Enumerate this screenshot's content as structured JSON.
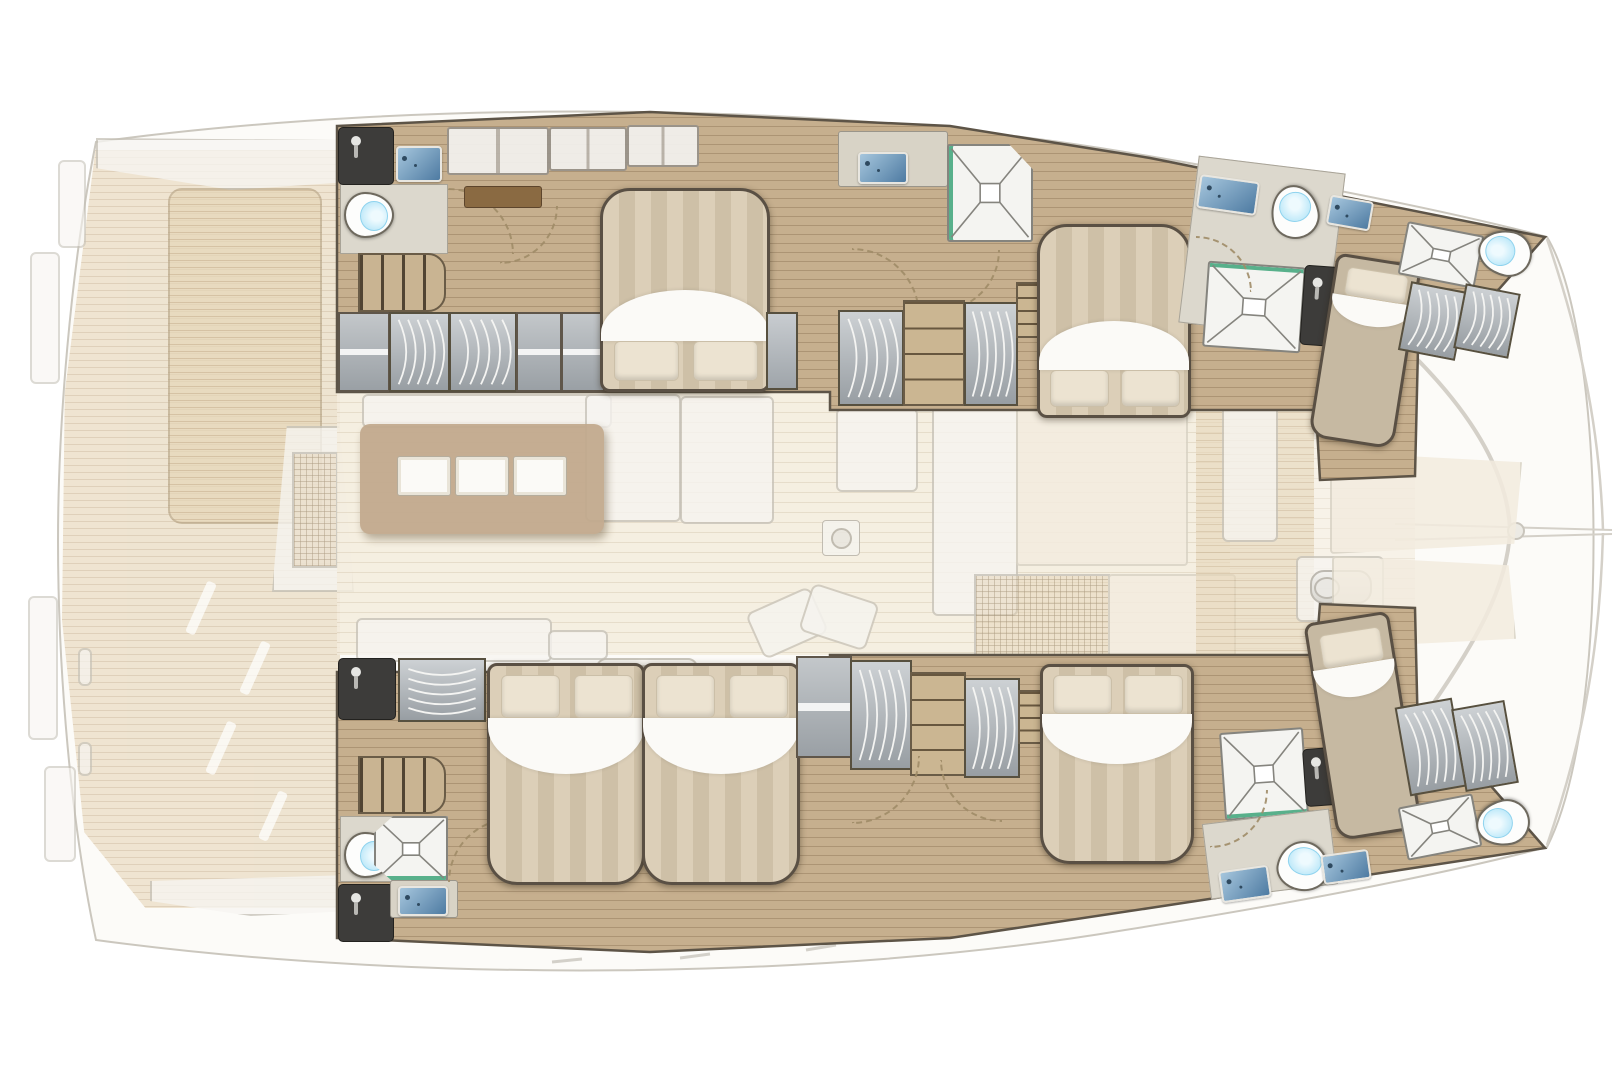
{
  "document": {
    "kind": "illustration",
    "subject": "catamaran yacht interior deck plan, top-down view",
    "visible_text": [],
    "orientation": {
      "bow": "right",
      "stern": "left",
      "port_hull": "top",
      "starboard_hull": "bottom"
    }
  },
  "areas": {
    "aft_deck": {
      "name": "aft cockpit deck",
      "style": "ghosted (semi-transparent)",
      "features": [
        "teak planked deck",
        "cockpit lounge pad",
        "helm / davit column with grating",
        "aft bench walkway",
        "transom steps",
        "cleats"
      ]
    },
    "salon": {
      "name": "main deck salon and galley",
      "style": "ghosted (semi-transparent)",
      "features": [
        "galley island with three worktop hatches",
        "settee along galley",
        "L-shaped lounge",
        "dining table",
        "floor drain",
        "scatter cushions",
        "aft sofa",
        "washbasin",
        "refrigerator column",
        "companionway grating",
        "sideboard slabs"
      ]
    },
    "foredeck": {
      "name": "foredeck and bow",
      "style": "ghosted (semi-transparent)",
      "features": [
        "teak cross deck",
        "deck hatch",
        "anchor windlass",
        "forward locker slabs",
        "bow crossbeam",
        "bowsprit with anchor roller",
        "bridle lines to both bows"
      ]
    },
    "port_hull": {
      "label": "port hull (top band)",
      "rooms": [
        {
          "name": "aft heads",
          "fixtures": [
            "dark shower cubicle with mixer",
            "washbasin",
            "toilet",
            "door swing arc"
          ]
        },
        {
          "name": "aft companionway",
          "fixtures": [
            "steps",
            "shelf locker",
            "hanging wardrobe",
            "hanging wardrobe",
            "shelf lockers"
          ]
        },
        {
          "name": "aft double cabin",
          "fixtures": [
            "double berth with two pillows (head inboard)",
            "overhead lockers",
            "vanity desk",
            "seat bench"
          ]
        },
        {
          "name": "mid shower room",
          "fixtures": [
            "washbasin counter",
            "corner shower tray with glass edge"
          ]
        },
        {
          "name": "mid double cabin",
          "fixtures": [
            "hanging wardrobe",
            "drawer dresser",
            "hanging wardrobe",
            "bedside shelf",
            "double berth with two pillows (head inboard)"
          ]
        },
        {
          "name": "forward heads",
          "fixtures": [
            "washbasin",
            "toilet",
            "shower tray",
            "dark shower cubicle",
            "door swing arcs"
          ]
        },
        {
          "name": "forepeak crew cabin",
          "fixtures": [
            "single berth with pillow",
            "washbasin",
            "shower tray",
            "toilet",
            "two lockers"
          ]
        }
      ]
    },
    "starboard_hull": {
      "label": "starboard hull (bottom band)",
      "rooms": [
        {
          "name": "aft heads",
          "fixtures": [
            "toilet",
            "shower tray",
            "dark shower cubicle with mixer",
            "washbasin counter",
            "door swing arc"
          ]
        },
        {
          "name": "aft companionway",
          "fixtures": [
            "steps",
            "dark locker",
            "hanging wardrobe"
          ]
        },
        {
          "name": "aft double cabin",
          "fixtures": [
            "double berth with two pillows (head inboard)"
          ]
        },
        {
          "name": "mid double cabin",
          "fixtures": [
            "double berth with two pillows (head inboard)",
            "shelf locker",
            "hanging wardrobe",
            "drawer dresser",
            "hanging wardrobe",
            "bedside shelf"
          ]
        },
        {
          "name": "forward shower room and heads",
          "fixtures": [
            "shower tray",
            "dark shower cubicle",
            "toilet",
            "washbasin",
            "door swing arcs"
          ]
        },
        {
          "name": "forepeak crew cabin",
          "fixtures": [
            "single berth with pillow",
            "washbasin",
            "shower tray",
            "toilet",
            "two lockers"
          ]
        }
      ]
    }
  },
  "totals": {
    "double_berths": 5,
    "single_berths": 2,
    "toilets": 6,
    "shower_trays_and_cubicles": 9,
    "washbasins": 8
  },
  "palette": {
    "bg": "#ffffff",
    "outlineStroke": "#cbc7be",
    "ghostFill": "#fcfbf8",
    "hullWood": "#c6af8e",
    "hullPlank": "rgba(104,79,50,0.28)",
    "hullStroke": "#5d5447",
    "teak": "#e6d6b8",
    "teakLine": "rgba(176,146,106,0.5)",
    "salonFloor": "#f4edde",
    "salonLine": "rgba(196,176,146,0.35)",
    "ghostWhite": "#f7f5f1",
    "ghostBorder": "#c6c2b8",
    "islandTan": "#c2a98d",
    "frameDark": "#5a5044",
    "stripeA": "#dccfb8",
    "stripeB": "#cec0a7",
    "pillow": "#ece3d1",
    "sheet": "#fbfaf7",
    "dresser": "#cbb692",
    "steps": "#c9b492",
    "bathFloor": "#dcd8cd",
    "shower": "#f4f4f1",
    "showerLine": "#85847e",
    "cubicle": "#3d3c3a",
    "sinkA": "#a6c6dd",
    "sinkB": "#4e7ba2",
    "water": "#bfe9f9",
    "desk": "#8a6a42",
    "green": "#58b08b",
    "dash": "#a08c68",
    "singleBed": "#c6b9a2",
    "cream": "#f3ecdf"
  }
}
